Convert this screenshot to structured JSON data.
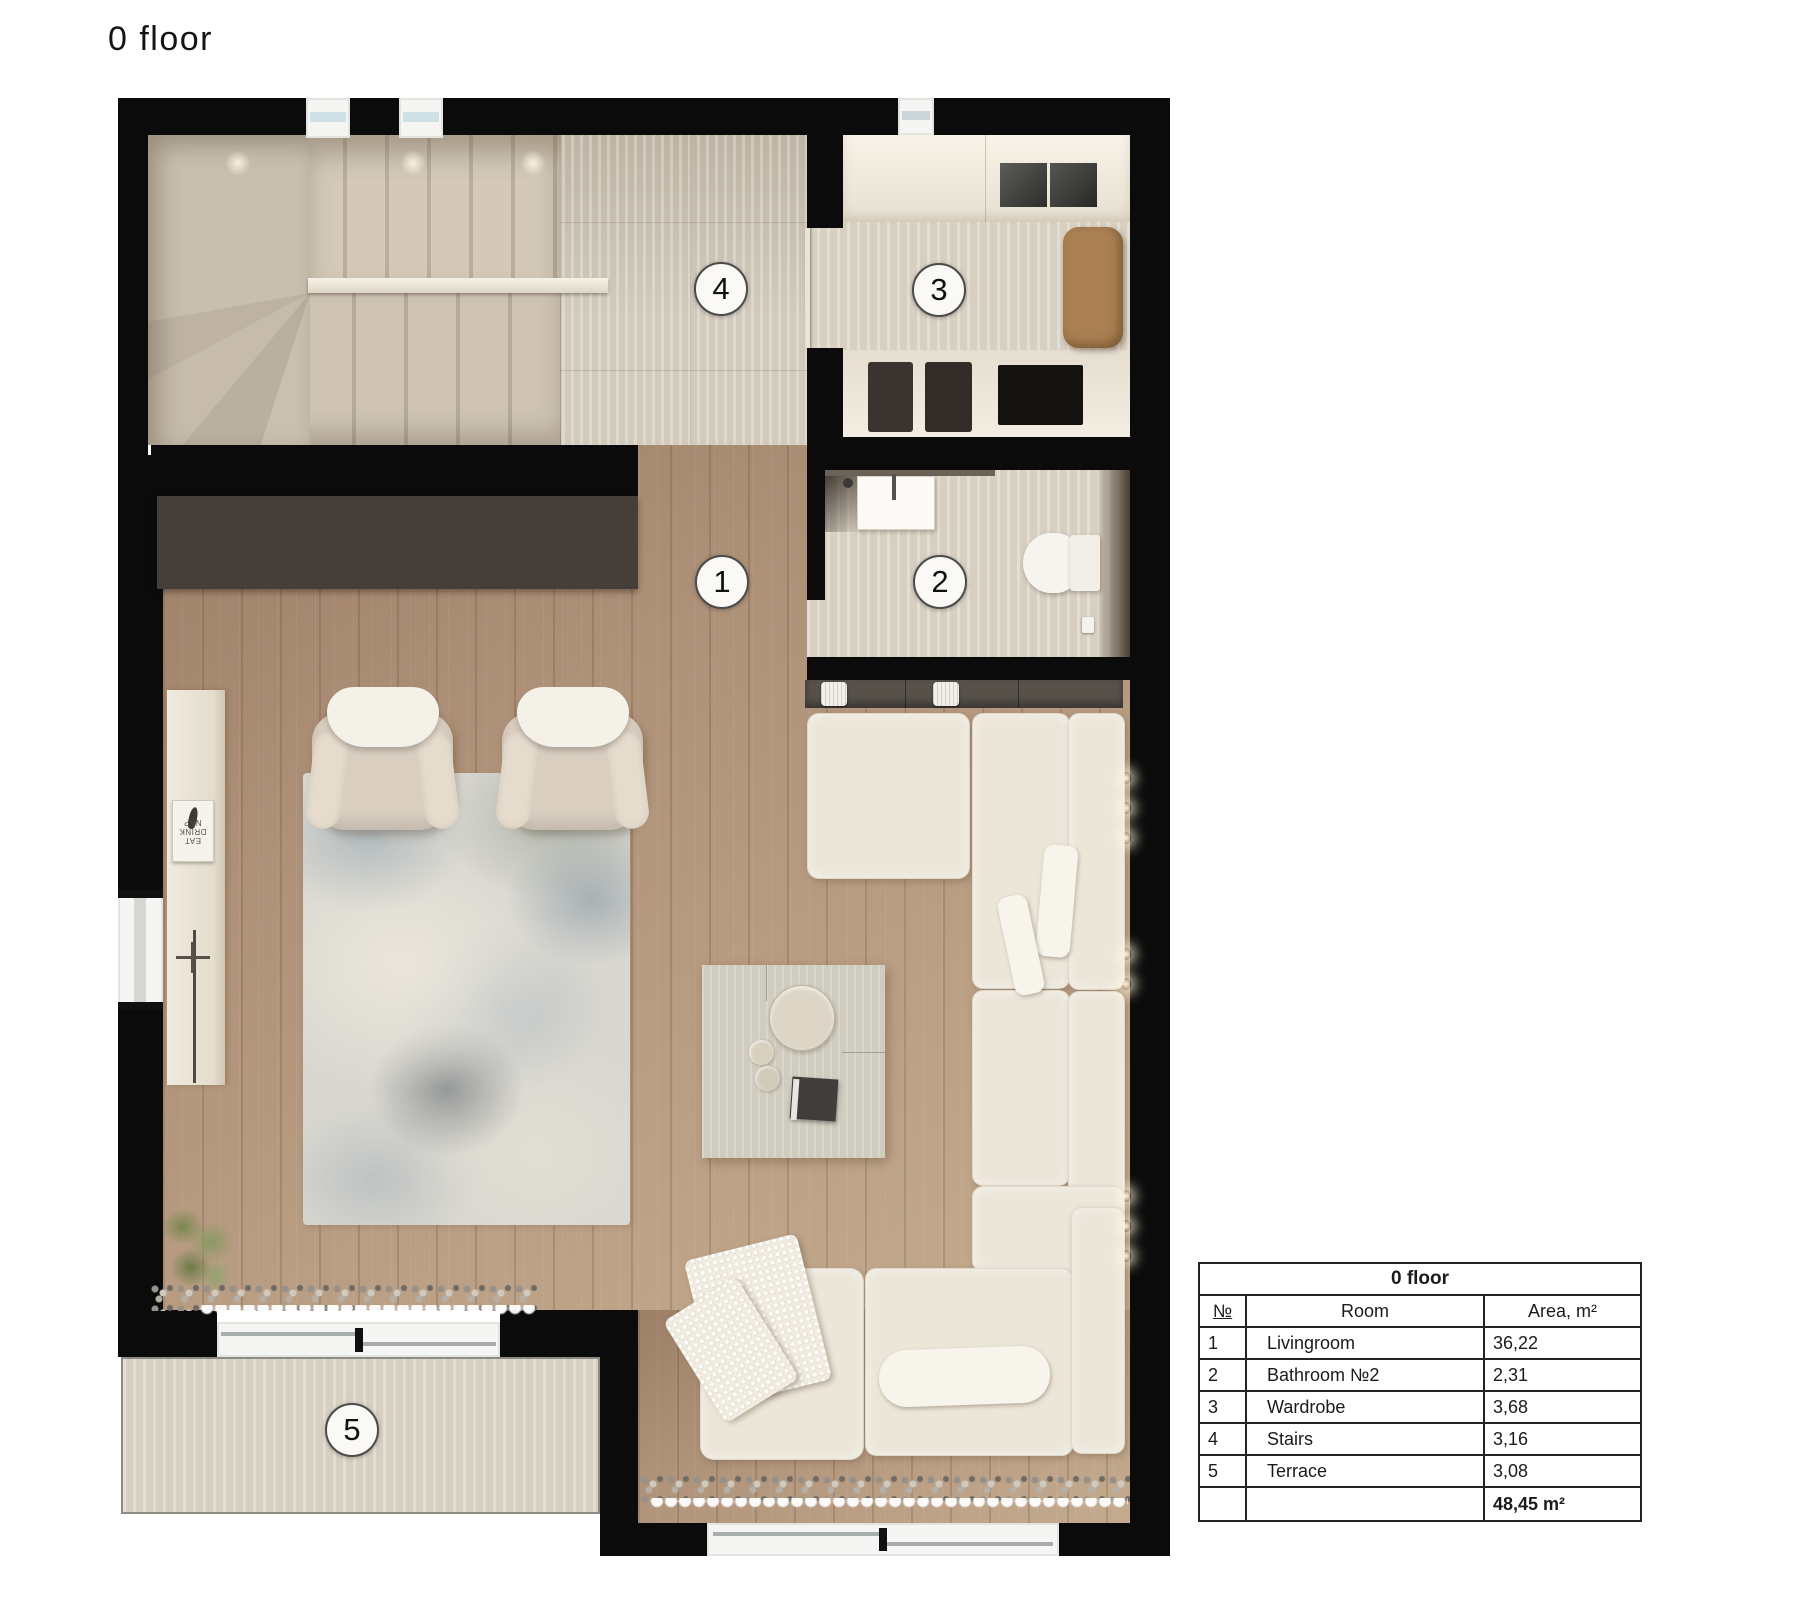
{
  "page": {
    "title": "0 floor",
    "background": "#ffffff"
  },
  "plan": {
    "rooms": [
      {
        "number": "1",
        "name": "Livingroom"
      },
      {
        "number": "2",
        "name": "Bathroom №2"
      },
      {
        "number": "3",
        "name": "Wardrobe"
      },
      {
        "number": "4",
        "name": "Stairs"
      },
      {
        "number": "5",
        "name": "Terrace"
      }
    ],
    "kitchen_poster_text_lines": {
      "line1": "EAT",
      "line2": "DRINK",
      "line3": "NAP"
    },
    "colors": {
      "wall": "#0b0b0b",
      "accent_cabinet_brown": "#463e38",
      "wood_floor": "#b2957b",
      "travertine_floor": "#cdc5b5",
      "sofa_cream": "#ece6d9",
      "bench_tan": "#aa8052",
      "rug_base": "#d9d7d0",
      "terrace_border": "#8d8d85"
    }
  },
  "legend_table": {
    "title": "0 floor",
    "columns": {
      "num": "№",
      "room": "Room",
      "area": "Area, m²"
    },
    "rows": [
      {
        "num": "1",
        "room": "Livingroom",
        "area": "36,22"
      },
      {
        "num": "2",
        "room": "Bathroom №2",
        "area": "2,31"
      },
      {
        "num": "3",
        "room": "Wardrobe",
        "area": "3,68"
      },
      {
        "num": "4",
        "room": "Stairs",
        "area": "3,16"
      },
      {
        "num": "5",
        "room": "Terrace",
        "area": "3,08"
      }
    ],
    "total_area": "48,45 m²"
  }
}
